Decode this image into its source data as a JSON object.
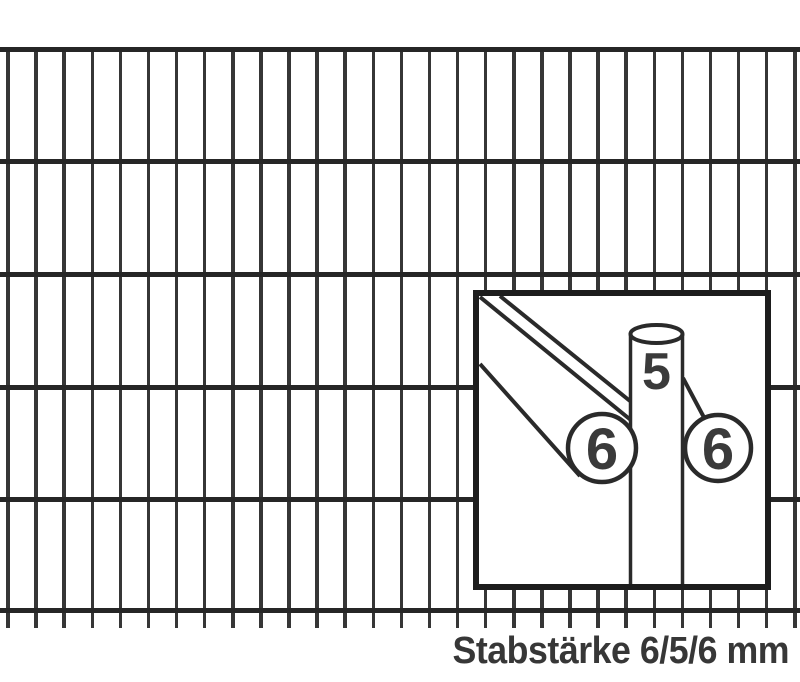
{
  "caption": "Stabstärke 6/5/6 mm",
  "inset": {
    "vertical_rod_label": "5",
    "front_rod_label": "6",
    "rear_rod_label": "6"
  },
  "colors": {
    "background": "#ffffff",
    "vertical_wire": "#363636",
    "horizontal_wire": "#262626",
    "inset_border": "#1d1d1d",
    "diagram_line": "#2a2a2a",
    "digit": "#3a3a3a",
    "caption": "#373737"
  },
  "mesh": {
    "vertical_wires": {
      "count": 29,
      "first_x": 8,
      "spacing": 28.1,
      "width": 3.5,
      "top": 47,
      "bottom": 628
    },
    "horizontal_wires": {
      "ys": [
        47,
        159,
        272,
        385,
        497,
        608
      ],
      "thickness": 4.5,
      "length": 800
    }
  }
}
